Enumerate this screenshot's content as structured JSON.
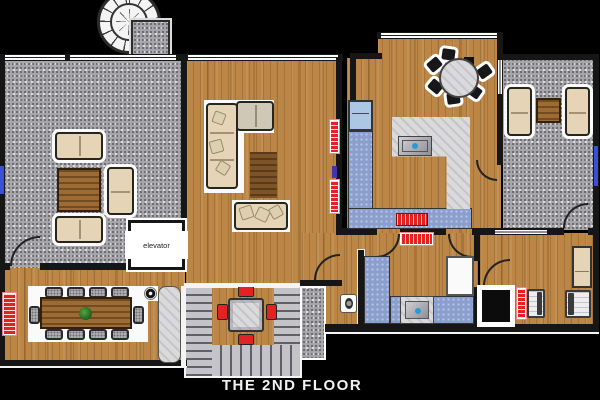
{
  "floor_label": "THE 2ND FLOOR",
  "palette": {
    "wood": "#bc8746",
    "carpet": "#a7a7ab",
    "marble": "#dadadc",
    "counter_blue": "#8b9fce",
    "fridge_blue": "#abc7e3",
    "sofa_beige": "#e5d5b6",
    "cushion_gray": "#cfc8b6",
    "table_brown": "#9c6c34",
    "rug_brown": "#7d5428",
    "accent_red": "#e32222",
    "wall": "#161616",
    "window_blue": "#3b4fd8",
    "chair_black": "#17171a",
    "chair_gray": "#b9b9bd",
    "stair_light": "#c4c4c8",
    "stair_dark": "#606066",
    "mat_white": "#fafafa",
    "bg": "#000000",
    "title_color": "#f2f2f2"
  },
  "rooms": {
    "family_room": {
      "floor": "carpet",
      "furniture": [
        "sofa",
        "sofa",
        "sofa",
        "coffee-table",
        "window"
      ]
    },
    "elevator": {
      "label": "elevator"
    },
    "dining_room": {
      "floor": "wood",
      "furniture": [
        "dining-table",
        "chairs-x10",
        "plant",
        "radiator",
        "sideboard",
        "speaker"
      ]
    },
    "living_room": {
      "floor": "wood",
      "furniture": [
        "l-shaped-sofa",
        "pillows",
        "rug",
        "radiator",
        "radiator"
      ]
    },
    "stairwell": {
      "furniture": [
        "spiral-staircase",
        "u-staircase",
        "cafe-table",
        "red-chairs-x4"
      ]
    },
    "kitchen": {
      "floor": "wood",
      "furniture": [
        "fridge",
        "blue-counter",
        "marble-island",
        "sink",
        "stove",
        "round-table",
        "black-chairs-x6"
      ]
    },
    "sitting_room": {
      "floor": "carpet",
      "furniture": [
        "sofa",
        "sofa",
        "side-table",
        "window"
      ]
    },
    "bathroom": {
      "floor": "wood",
      "furniture": [
        "vanity-counter",
        "sink",
        "toilet",
        "shower-door",
        "radiator"
      ]
    },
    "bedroom": {
      "floor": "wood",
      "furniture": [
        "bed",
        "bed",
        "closet",
        "desk",
        "radiator"
      ]
    }
  }
}
